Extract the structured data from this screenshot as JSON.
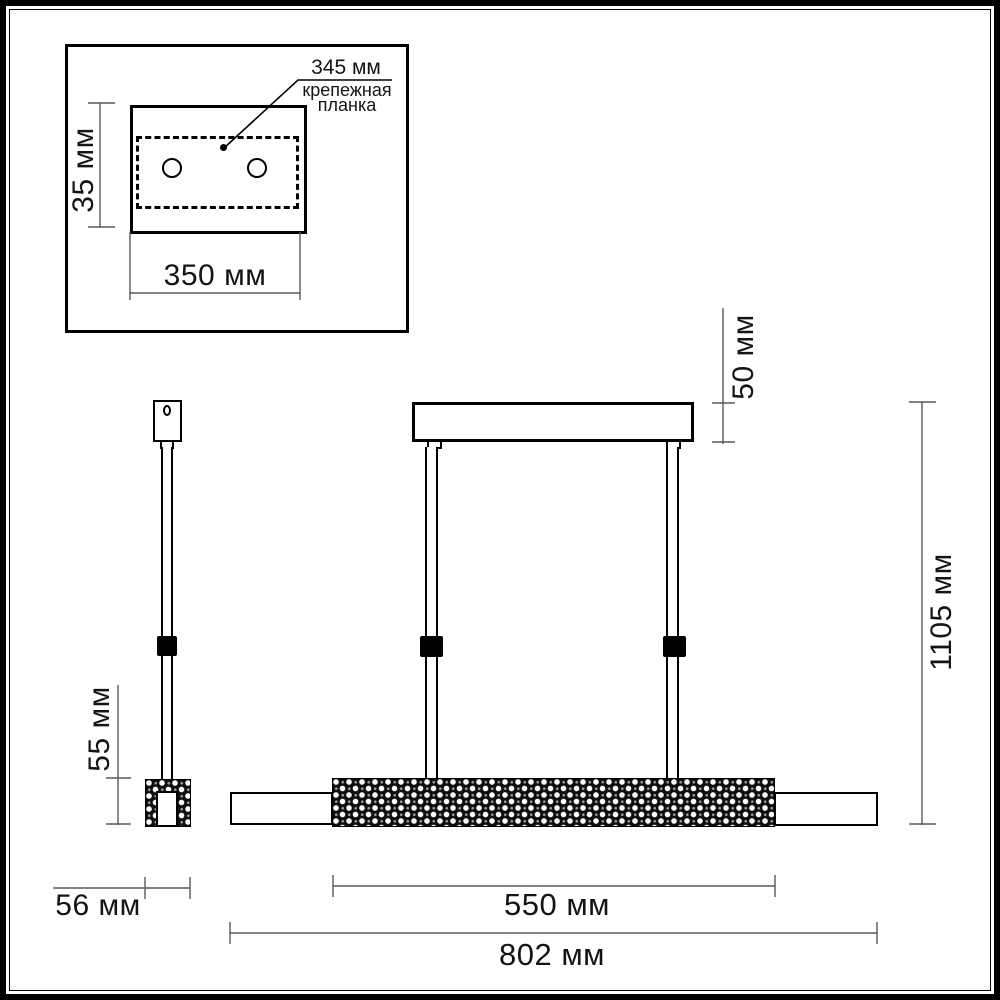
{
  "drawing": {
    "inset": {
      "callout_value": "345 мм",
      "callout_name_line1": "крепежная",
      "callout_name_line2": "планка",
      "plate_height_dim": "35 мм",
      "plate_width_dim": "350 мм"
    },
    "side_view": {
      "body_height_dim": "55 мм",
      "body_width_dim": "56 мм"
    },
    "front_view": {
      "canopy_height_dim": "50 мм",
      "overall_height_dim": "1105 мм",
      "crystal_length_dim": "550 мм",
      "overall_length_dim": "802 мм"
    },
    "colors": {
      "line": "#000000",
      "dim_line": "#595959",
      "background": "#ffffff"
    }
  }
}
